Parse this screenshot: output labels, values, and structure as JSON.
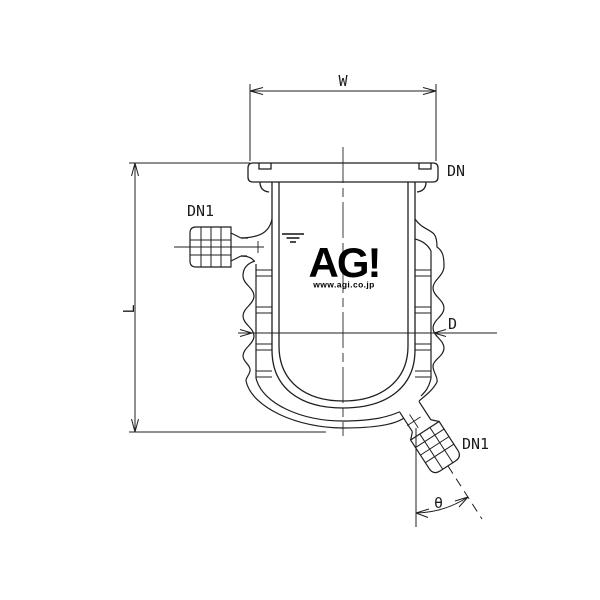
{
  "labels": {
    "width": "W",
    "length": "L",
    "diameter": "D",
    "angle": "θ",
    "flange_nominal": "DN",
    "side_port_nominal": "DN1",
    "bottom_port_nominal": "DN1"
  },
  "logo": {
    "text": "AG!",
    "url": "www.agi.co.jp"
  },
  "colors": {
    "line": "#1f1f1f",
    "centerline": "#4d4d4d",
    "background": "#ffffff",
    "logo": "#000000"
  }
}
